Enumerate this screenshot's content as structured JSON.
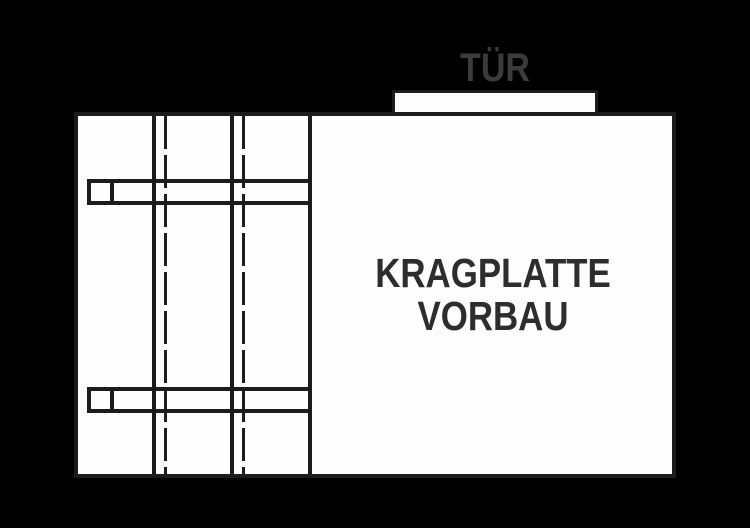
{
  "canvas": {
    "width": 750,
    "height": 528,
    "background": "#000000"
  },
  "labels": {
    "door": "TÜR",
    "area_line1": "KRAGPLATTE",
    "area_line2": "VORBAU"
  },
  "colors": {
    "outline": "#1c1c1c",
    "plan_fill": "#fdfdfd",
    "door_label": "#3b3b3b",
    "area_label": "#2d2d2d"
  }
}
